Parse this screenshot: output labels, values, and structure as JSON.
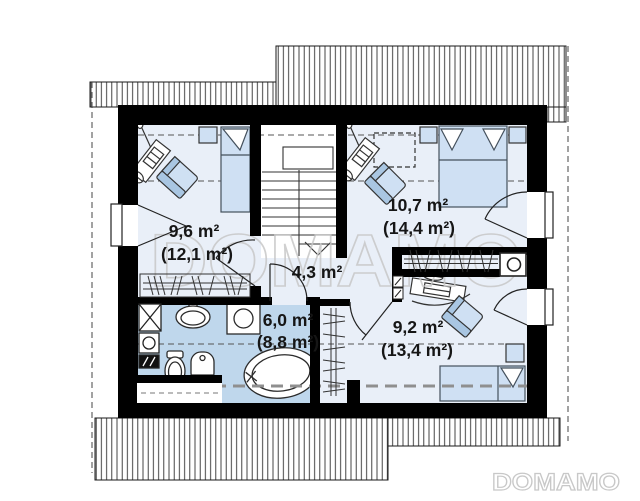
{
  "plan": {
    "title": "attic floor plan",
    "rooms": [
      {
        "id": "bedroom-1",
        "area": "9,6 m²",
        "floor_area": "(12,1 m²)"
      },
      {
        "id": "bedroom-2",
        "area": "10,7 m²",
        "floor_area": "(14,4 m²)"
      },
      {
        "id": "hall",
        "area": "4,3 m²",
        "floor_area": ""
      },
      {
        "id": "bathroom",
        "area": "6,0 m²",
        "floor_area": "(8,8 m²)"
      },
      {
        "id": "bedroom-3",
        "area": "9,2 m²",
        "floor_area": "(13,4 m²)"
      }
    ]
  },
  "watermarks": {
    "center": "DOMAMO",
    "corner": "DOMAMO"
  },
  "colors": {
    "wall": "#000000",
    "room_floor": "#e9eff8",
    "bathroom_floor": "#bfd7ec",
    "furniture_light": "#cfe0f3",
    "furniture_mid": "#a9c6e2",
    "outline": "#333333",
    "watermark": "#c8c8c8",
    "label": "#161616"
  }
}
